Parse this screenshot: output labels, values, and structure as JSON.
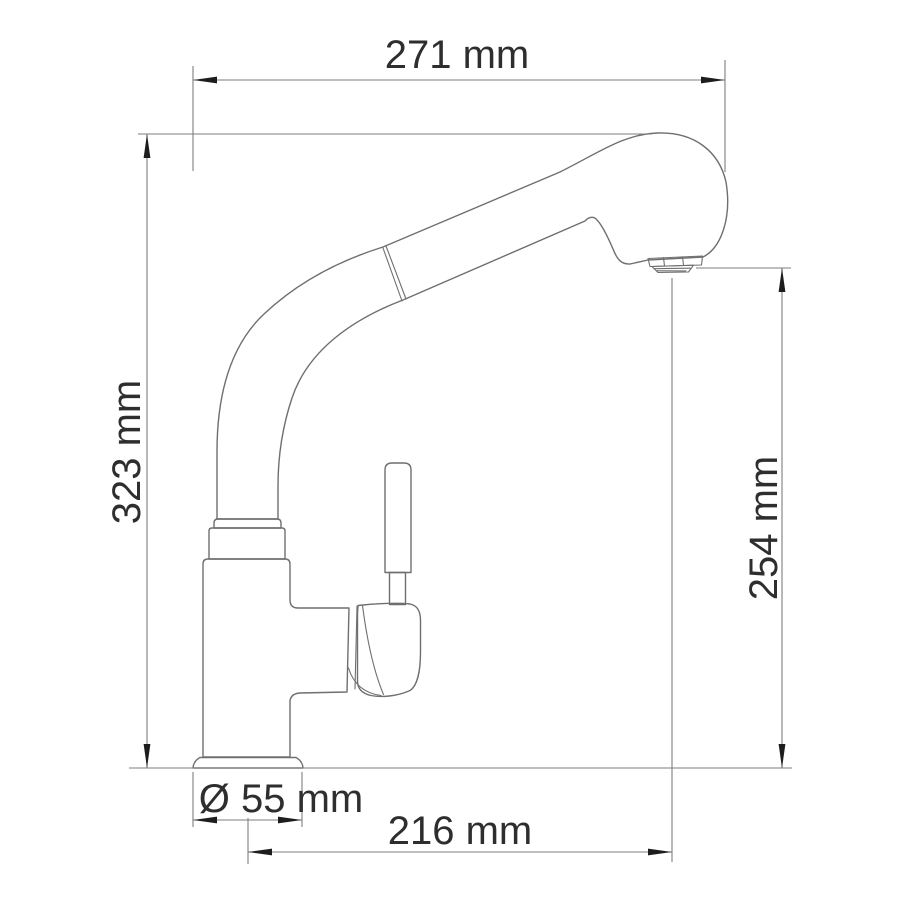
{
  "drawing": {
    "type": "technical-dimension-diagram",
    "subject": "single-lever kitchen mixer faucet with high curved pull-out spout, side view",
    "colors": {
      "bg": "#ffffff",
      "outline": "#6f6f6f",
      "dim": "#7e7e7e",
      "arrow": "#1d1d1d",
      "label": "#2e2e2e"
    },
    "dimensions": [
      {
        "id": "overall-width",
        "label": "271 mm",
        "value": 271,
        "unit": "mm",
        "orientation": "horizontal",
        "position": "top"
      },
      {
        "id": "overall-height",
        "label": "323 mm",
        "value": 323,
        "unit": "mm",
        "orientation": "vertical",
        "position": "left"
      },
      {
        "id": "outlet-height",
        "label": "254 mm",
        "value": 254,
        "unit": "mm",
        "orientation": "vertical",
        "position": "right"
      },
      {
        "id": "base-diameter",
        "label": "Ø 55 mm",
        "value": 55,
        "unit": "mm",
        "orientation": "horizontal",
        "position": "bottom"
      },
      {
        "id": "spout-reach",
        "label": "216 mm",
        "value": 216,
        "unit": "mm",
        "orientation": "horizontal",
        "position": "bottom"
      }
    ]
  }
}
